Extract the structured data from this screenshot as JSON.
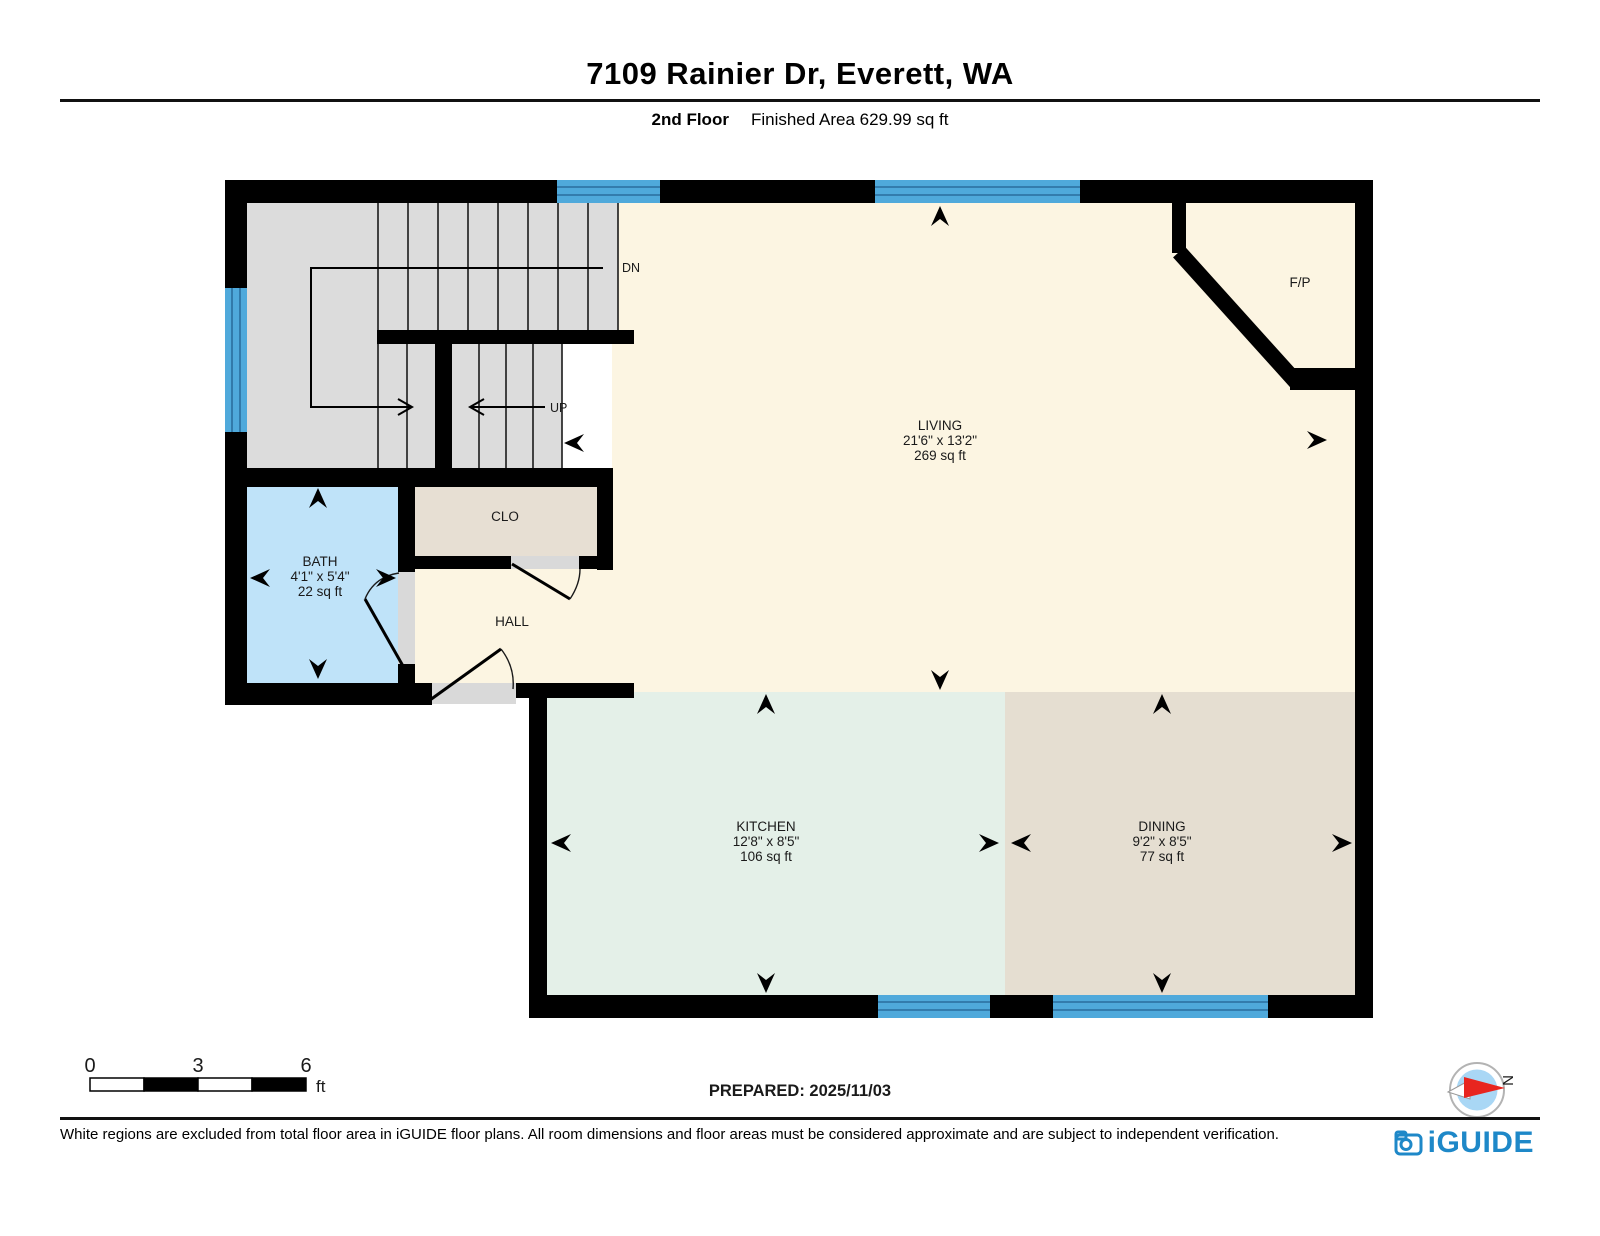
{
  "header": {
    "title": "7109 Rainier Dr, Everett, WA",
    "floor_label": "2nd Floor",
    "area_label": "Finished Area 629.99 sq ft"
  },
  "rooms": {
    "living": {
      "name": "LIVING",
      "dims": "21'6\" x 13'2\"",
      "area": "269 sq ft"
    },
    "kitchen": {
      "name": "KITCHEN",
      "dims": "12'8\" x 8'5\"",
      "area": "106 sq ft"
    },
    "dining": {
      "name": "DINING",
      "dims": "9'2\" x 8'5\"",
      "area": "77 sq ft"
    },
    "bath": {
      "name": "BATH",
      "dims": "4'1\" x 5'4\"",
      "area": "22 sq ft"
    },
    "closet": {
      "name": "CLO"
    },
    "hall": {
      "name": "HALL"
    },
    "fireplace": {
      "name": "F/P"
    }
  },
  "stairs": {
    "down_label": "DN",
    "up_label": "UP"
  },
  "scale_bar": {
    "tick0": "0",
    "tick1": "3",
    "tick2": "6",
    "unit": "ft"
  },
  "compass": {
    "north_label": "N"
  },
  "footer": {
    "prepared": "PREPARED: 2025/11/03",
    "disclaimer": "White regions are excluded from total floor area in iGUIDE floor plans. All room dimensions and floor areas must be considered approximate and are subject to independent verification.",
    "brand": "iGUIDE"
  },
  "colors": {
    "floor_main": "#FCF5E2",
    "floor_kitchen": "#E4F0E8",
    "floor_dining": "#E5DED1",
    "floor_bath": "#BFE3F9",
    "floor_closet": "#E7DFD3",
    "floor_stairs": "#DCDCDC",
    "door_opening": "#D9D9D9",
    "wall": "#000000",
    "window": "#4FA9DB",
    "window_line": "#2A6E9E",
    "brand_blue": "#1E88C8",
    "compass_red": "#E8251F",
    "compass_blue": "#A9D7F5"
  }
}
